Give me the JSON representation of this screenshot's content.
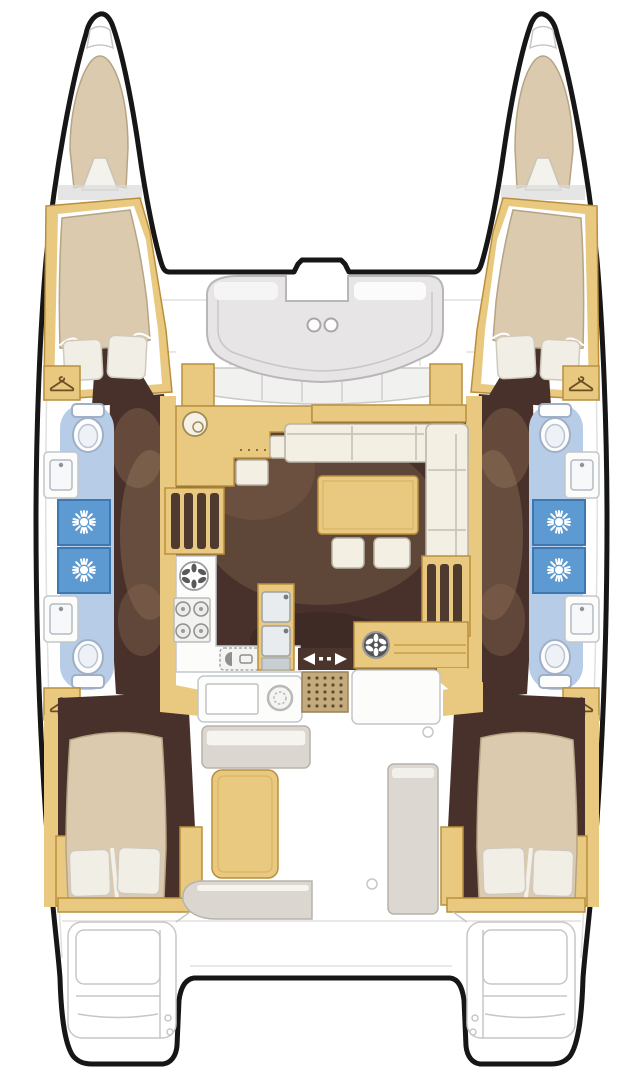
{
  "figure": {
    "type": "floor-plan",
    "subject": "catamaran yacht interior deck plan, top view",
    "hulls": 2,
    "double_cabins": 4,
    "forepeak_berths": 2,
    "toilets": 4,
    "shower_stalls": 4,
    "wardrobes": 4,
    "areas": [
      "port-forepeak-berth",
      "starboard-forepeak-berth",
      "port-forward-cabin",
      "starboard-forward-cabin",
      "port-forward-head",
      "port-aft-head",
      "starboard-forward-head",
      "starboard-aft-head",
      "forward-cockpit-bench",
      "saloon-sofa",
      "saloon-table",
      "galley-stove",
      "galley-double-sink",
      "chart-counter",
      "sliding-door",
      "cockpit-table",
      "cockpit-benches",
      "port-aft-cabin",
      "starboard-aft-cabin",
      "port-transom-steps",
      "starboard-transom-steps"
    ]
  },
  "icons": {
    "coat-hanger-icon": "wardrobe locker marker",
    "shower-spray-icon": "white sunburst on blue shower pan",
    "toilet-icon": "marine toilet, top view",
    "sink-icon": "basin with faucet dot",
    "burner-icon": "stove burner ring",
    "round-basin-icon": "round sink / burner with petal marks",
    "slide-arrows-icon": "sliding patio door direction arrows",
    "cup-holder-icon": "two round cup holders",
    "door-mat-icon": "dotted tread mat"
  },
  "colors": {
    "outline": "#161616",
    "faint": "#c7c7c7",
    "tan": "#e9c87f",
    "tan_dark": "#b98f3e",
    "cream": "#f3efe2",
    "cream_stroke": "#b8b4a7",
    "floor": "#47312a",
    "floor_light": "#8a6a50",
    "bed": "#dbcaae",
    "bed_stroke": "#b6a485",
    "pillow": "#f1eee6",
    "bath_blue": "#b7cde7",
    "shower_blue": "#5e9ad2",
    "shower_dark": "#3e78b0",
    "cockpit_grey": "#dbd7d0",
    "bench_grey": "#e8e5e7",
    "steel": "#e9ecee",
    "steel_dark": "#9aa2a8"
  }
}
